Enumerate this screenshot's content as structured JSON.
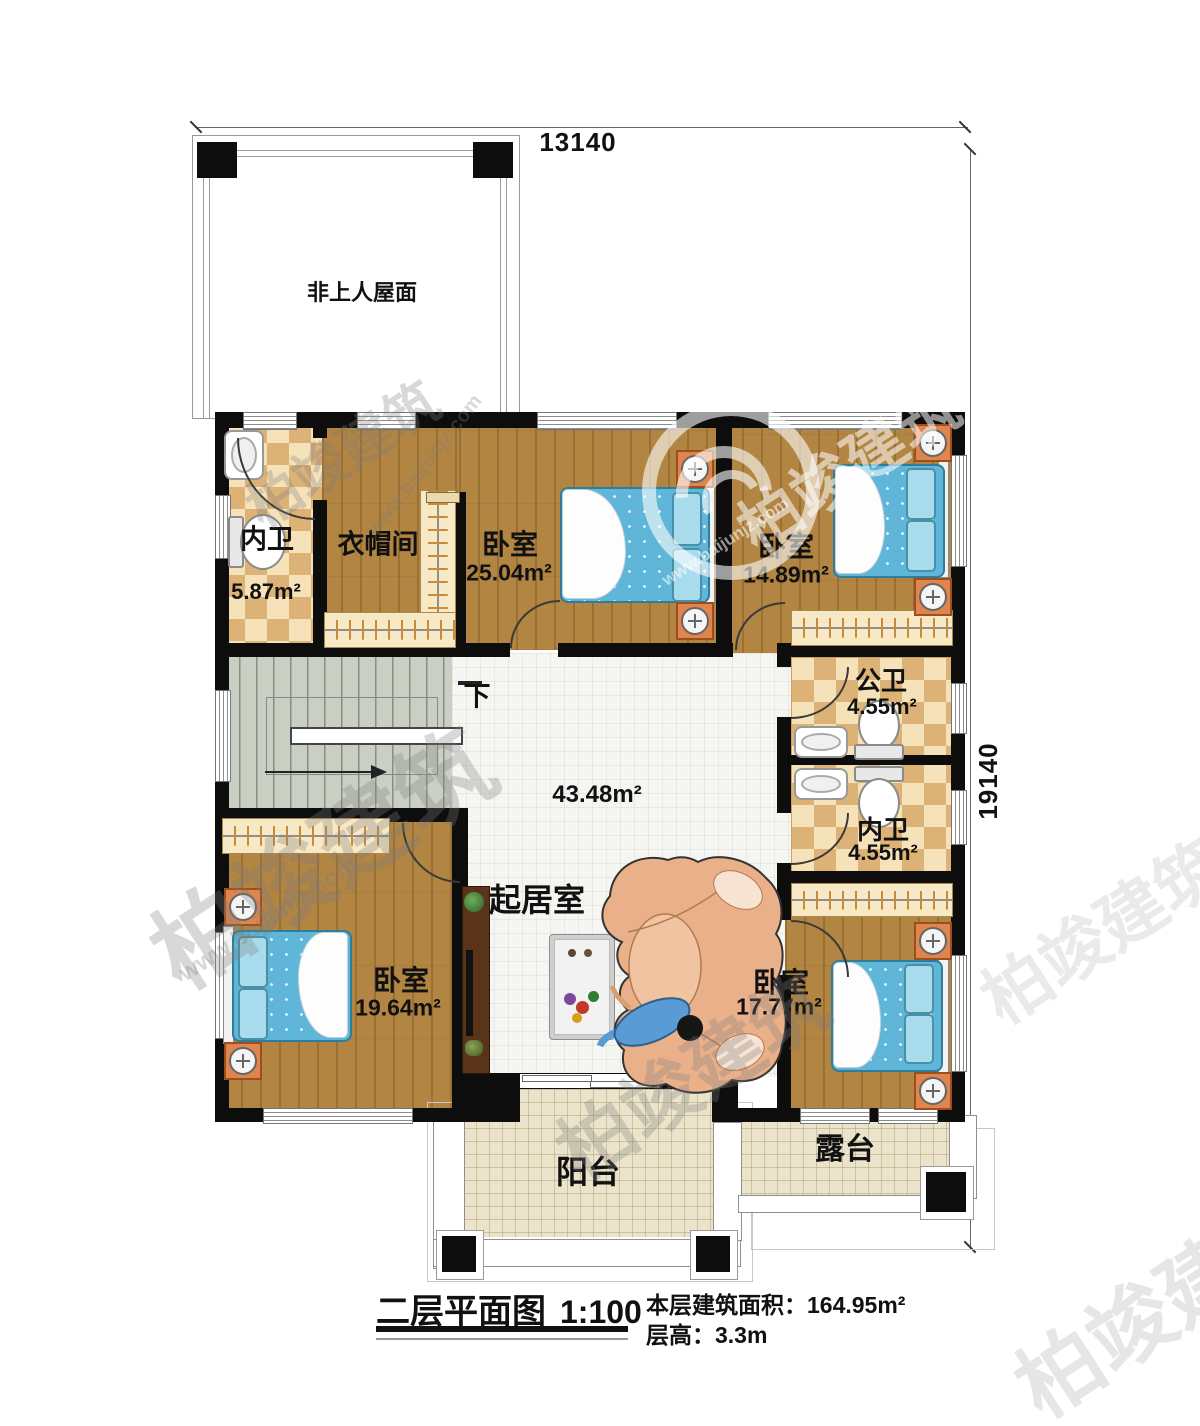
{
  "title_block": {
    "title": "二层平面图",
    "scale": "1:100",
    "floor_area_label": "本层建筑面积：",
    "floor_area": "164.95m²",
    "floor_height_label": "层高：",
    "floor_height": "3.3m"
  },
  "annotations": {
    "roof": "非上人屋面",
    "stair_down": "下",
    "dim_width": "13140",
    "dim_depth": "19140"
  },
  "rooms": [
    {
      "name": "内卫",
      "area": "5.87m²"
    },
    {
      "name": "衣帽间"
    },
    {
      "name": "卧室",
      "area": "25.04m²"
    },
    {
      "name": "卧室",
      "area": "14.89m²"
    },
    {
      "name": "公卫",
      "area": "4.55m²"
    },
    {
      "name": "内卫",
      "area": "4.55m²"
    },
    {
      "name": "起居室",
      "area": "43.48m²"
    },
    {
      "name": "卧室",
      "area": "19.64m²"
    },
    {
      "name": "卧室",
      "area": "17.77m²"
    },
    {
      "name": "阳台"
    },
    {
      "name": "露台"
    }
  ],
  "watermark": {
    "brand": "柏竣建筑",
    "url": "www.baijunjz.com"
  },
  "colors": {
    "wall": "#0d0d0d",
    "wood_floor": "#b28543",
    "bath_tile_light": "#f6e2b8",
    "bath_tile_dark": "#dcb277",
    "living_tile": "#f5f5f2",
    "outdoor_tile": "#ebe4cb",
    "stair_floor": "#c9cfc2",
    "bed_blue": "#5fb6d8",
    "sofa_tan": "#eab08a"
  }
}
